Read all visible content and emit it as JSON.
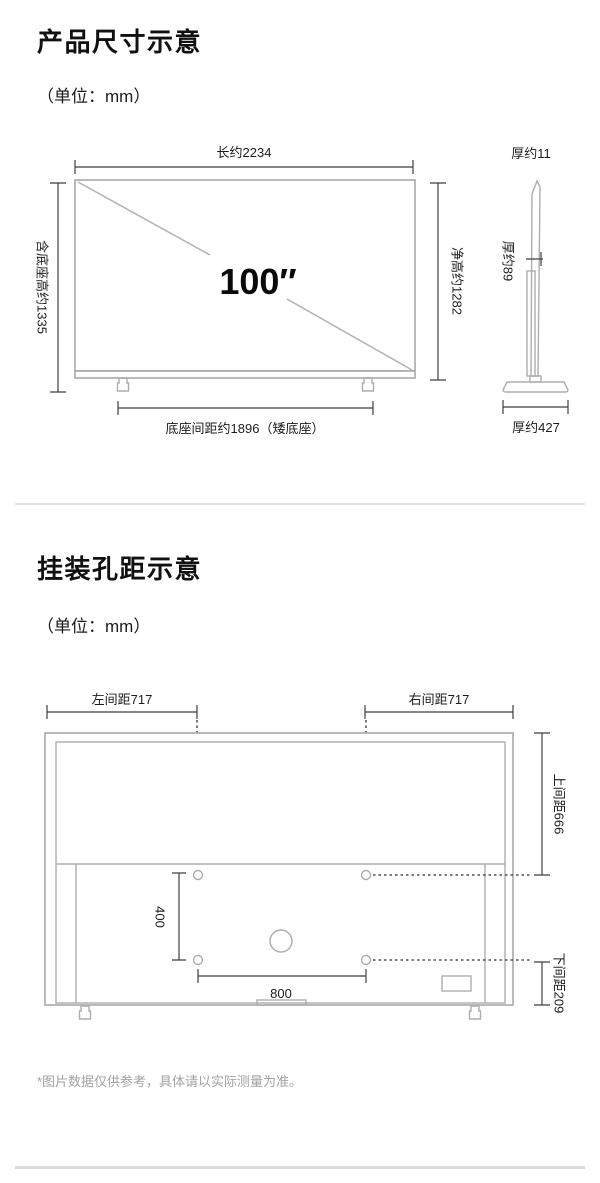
{
  "section1": {
    "title": "产品尺寸示意",
    "unit": "（单位：mm）",
    "front": {
      "width": "长约2234",
      "total_height": "含底座高约1335",
      "net_height": "净高约1282",
      "base_distance": "底座间距约1896（矮底座）",
      "diagonal": "100″"
    },
    "side": {
      "top_thickness": "厚约11",
      "mid_thickness": "厚约89",
      "base_depth": "厚约427"
    }
  },
  "section2": {
    "title": "挂装孔距示意",
    "unit": "（单位：mm）",
    "rear": {
      "left_spacing": "左间距717",
      "right_spacing": "右间距717",
      "top_spacing": "上间距666",
      "bottom_spacing": "下间距209",
      "hole_height": "400",
      "hole_width": "800"
    }
  },
  "footer": {
    "note": "*图片数据仅供参考，具体请以实际测量为准。"
  }
}
